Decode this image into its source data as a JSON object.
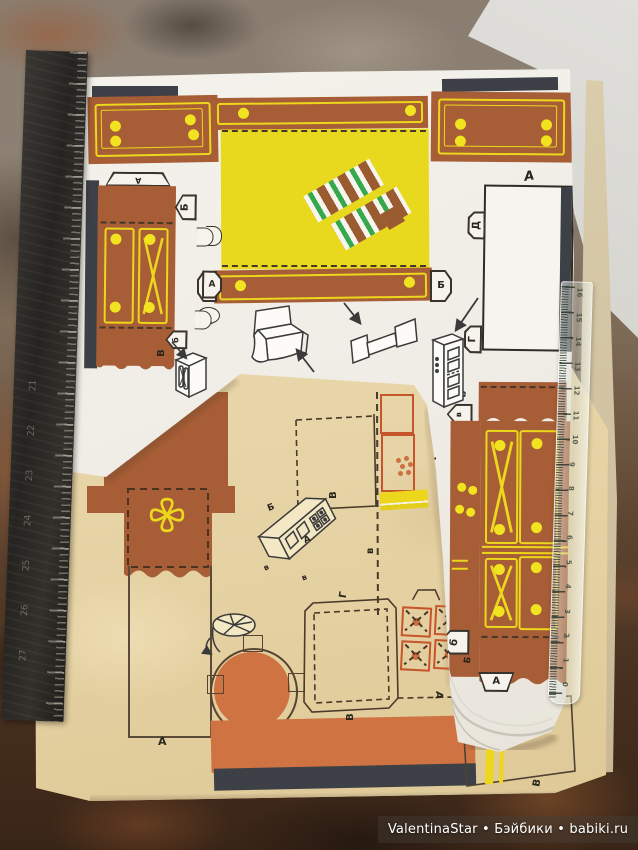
{
  "watermark": {
    "text": "ValentinaStar • Бэйбики • babiki.ru"
  },
  "labels": {
    "A": "А",
    "B": "Б",
    "V": "В",
    "G": "Г",
    "D": "Д",
    "b": "б",
    "v": "в"
  },
  "rulers": {
    "left_numbers": [
      "21",
      "22",
      "23",
      "24",
      "25",
      "26",
      "27"
    ],
    "right_numbers": [
      "16",
      "15",
      "14",
      "13",
      "12",
      "11",
      "10",
      "9",
      "8",
      "7",
      "6",
      "5",
      "4",
      "3",
      "2",
      "1",
      "0"
    ]
  },
  "colors": {
    "furniture_brown": "#a75d35",
    "accent_yellow": "#ecd71d",
    "sheet_orange": "#cf7342",
    "tan_paper": "#e7d4a6",
    "pillow_green": "#35a94c",
    "pillow_brown": "#9b5b31",
    "dark_strip": "#3d4046",
    "tile_orange": "#c7552b"
  }
}
